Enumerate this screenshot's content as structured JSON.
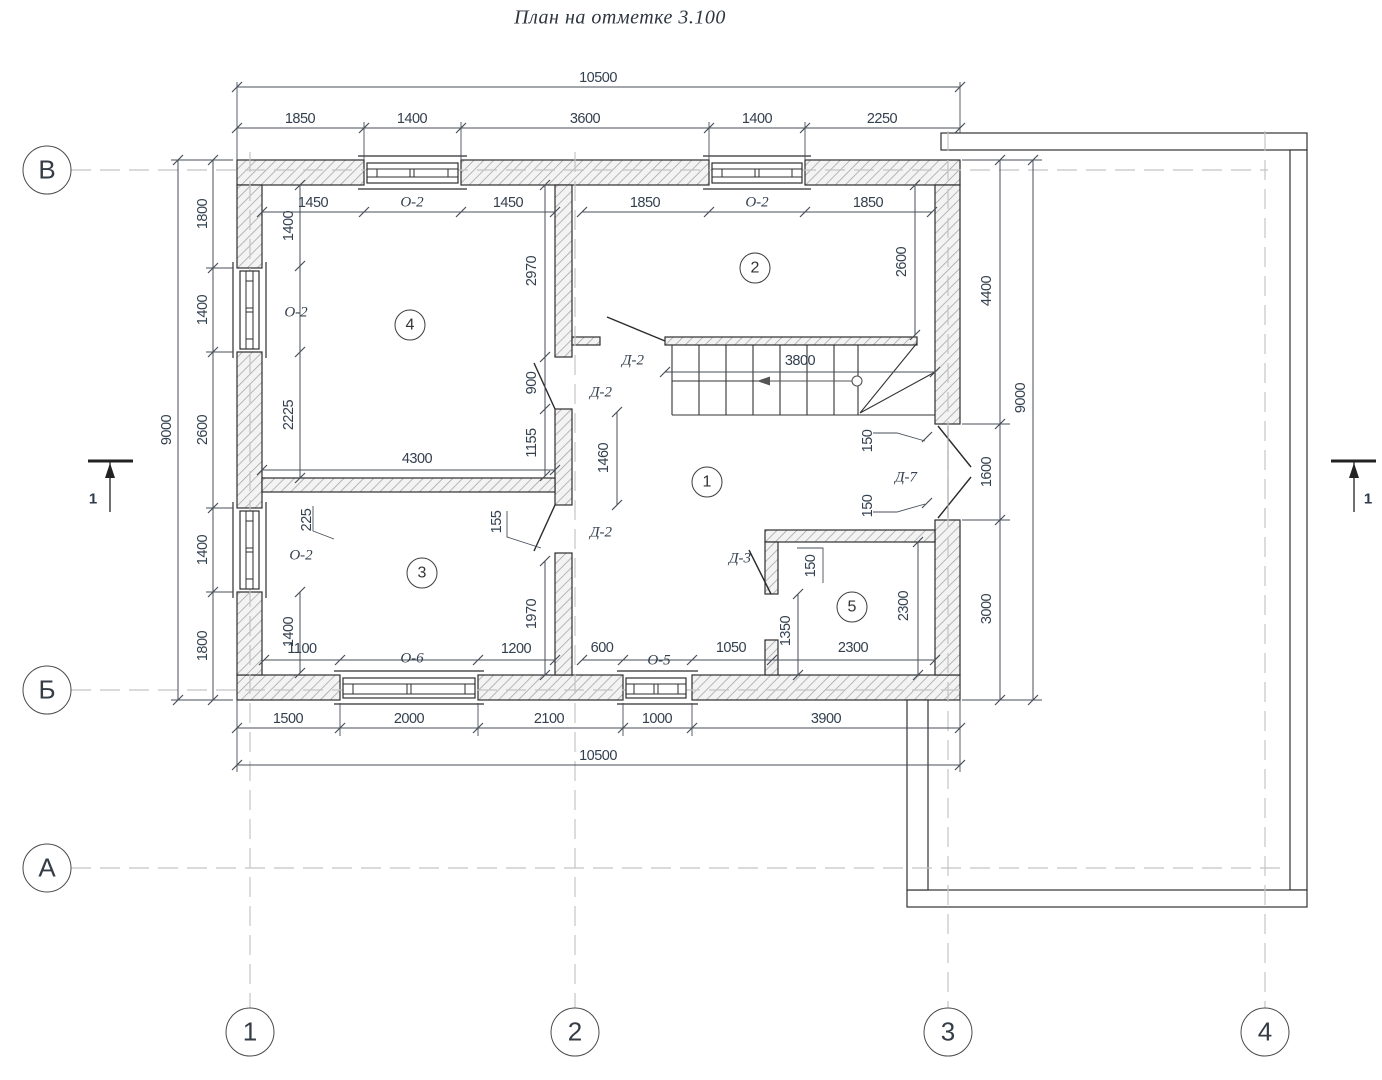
{
  "title": "План на отметке 3.100",
  "grid_axes": {
    "rows": [
      {
        "label": "В",
        "cx": 47,
        "cy": 170
      },
      {
        "label": "Б",
        "cx": 47,
        "cy": 690
      },
      {
        "label": "А",
        "cx": 47,
        "cy": 868
      }
    ],
    "cols": [
      {
        "label": "1",
        "cx": 250,
        "cy": 1032
      },
      {
        "label": "2",
        "cx": 575,
        "cy": 1032
      },
      {
        "label": "3",
        "cx": 948,
        "cy": 1032
      },
      {
        "label": "4",
        "cx": 1265,
        "cy": 1032
      }
    ]
  },
  "rooms": [
    {
      "number": "1",
      "cx": 707,
      "cy": 482
    },
    {
      "number": "2",
      "cx": 755,
      "cy": 268
    },
    {
      "number": "3",
      "cx": 422,
      "cy": 573
    },
    {
      "number": "4",
      "cx": 410,
      "cy": 325
    },
    {
      "number": "5",
      "cx": 852,
      "cy": 607
    }
  ],
  "section_marks": [
    {
      "label": "1",
      "x": 93,
      "y": 499
    },
    {
      "label": "1",
      "x": 1368,
      "y": 499
    }
  ],
  "opening_labels": [
    {
      "text": "О-2",
      "x": 412,
      "y": 203
    },
    {
      "text": "О-2",
      "x": 757,
      "y": 203
    },
    {
      "text": "О-2",
      "x": 296,
      "y": 313
    },
    {
      "text": "О-2",
      "x": 301,
      "y": 556
    },
    {
      "text": "О-6",
      "x": 412,
      "y": 659
    },
    {
      "text": "О-5",
      "x": 659,
      "y": 661
    },
    {
      "text": "Д-2",
      "x": 633,
      "y": 361
    },
    {
      "text": "Д-2",
      "x": 601,
      "y": 393
    },
    {
      "text": "Д-2",
      "x": 601,
      "y": 533
    },
    {
      "text": "Д-3",
      "x": 740,
      "y": 559
    },
    {
      "text": "Д-7",
      "x": 906,
      "y": 478
    }
  ],
  "dimensions": [
    {
      "text": "10500",
      "x": 598,
      "y": 78,
      "rot": 0
    },
    {
      "text": "1850",
      "x": 300,
      "y": 119,
      "rot": 0
    },
    {
      "text": "1400",
      "x": 412,
      "y": 119,
      "rot": 0
    },
    {
      "text": "3600",
      "x": 585,
      "y": 119,
      "rot": 0
    },
    {
      "text": "1400",
      "x": 757,
      "y": 119,
      "rot": 0
    },
    {
      "text": "2250",
      "x": 882,
      "y": 119,
      "rot": 0
    },
    {
      "text": "1450",
      "x": 313,
      "y": 203,
      "rot": 0
    },
    {
      "text": "1450",
      "x": 508,
      "y": 203,
      "rot": 0
    },
    {
      "text": "1850",
      "x": 645,
      "y": 203,
      "rot": 0
    },
    {
      "text": "1850",
      "x": 868,
      "y": 203,
      "rot": 0
    },
    {
      "text": "9000",
      "x": 167,
      "y": 430,
      "rot": 1
    },
    {
      "text": "1800",
      "x": 203,
      "y": 214,
      "rot": 1
    },
    {
      "text": "1400",
      "x": 203,
      "y": 310,
      "rot": 1
    },
    {
      "text": "2600",
      "x": 203,
      "y": 430,
      "rot": 1
    },
    {
      "text": "1400",
      "x": 203,
      "y": 550,
      "rot": 1
    },
    {
      "text": "1800",
      "x": 203,
      "y": 646,
      "rot": 1
    },
    {
      "text": "1400",
      "x": 289,
      "y": 226,
      "rot": 1
    },
    {
      "text": "2225",
      "x": 289,
      "y": 415,
      "rot": 1
    },
    {
      "text": "225",
      "x": 307,
      "y": 520,
      "rot": 1
    },
    {
      "text": "1400",
      "x": 289,
      "y": 632,
      "rot": 1
    },
    {
      "text": "1100",
      "x": 302,
      "y": 649,
      "rot": 0
    },
    {
      "text": "2970",
      "x": 532,
      "y": 271,
      "rot": 1
    },
    {
      "text": "900",
      "x": 532,
      "y": 383,
      "rot": 1
    },
    {
      "text": "1155",
      "x": 532,
      "y": 443,
      "rot": 1
    },
    {
      "text": "4300",
      "x": 417,
      "y": 459,
      "rot": 0
    },
    {
      "text": "1970",
      "x": 532,
      "y": 614,
      "rot": 1
    },
    {
      "text": "155",
      "x": 497,
      "y": 522,
      "rot": 1
    },
    {
      "text": "1200",
      "x": 516,
      "y": 649,
      "rot": 0
    },
    {
      "text": "1460",
      "x": 604,
      "y": 458,
      "rot": 1
    },
    {
      "text": "3800",
      "x": 800,
      "y": 361,
      "rot": 0
    },
    {
      "text": "2600",
      "x": 902,
      "y": 262,
      "rot": 1
    },
    {
      "text": "600",
      "x": 602,
      "y": 648,
      "rot": 0
    },
    {
      "text": "1050",
      "x": 731,
      "y": 648,
      "rot": 0
    },
    {
      "text": "2300",
      "x": 853,
      "y": 648,
      "rot": 0
    },
    {
      "text": "1350",
      "x": 786,
      "y": 631,
      "rot": 1
    },
    {
      "text": "150",
      "x": 811,
      "y": 566,
      "rot": 1
    },
    {
      "text": "2300",
      "x": 904,
      "y": 606,
      "rot": 1
    },
    {
      "text": "150",
      "x": 868,
      "y": 441,
      "rot": 1
    },
    {
      "text": "150",
      "x": 868,
      "y": 506,
      "rot": 1
    },
    {
      "text": "4400",
      "x": 987,
      "y": 291,
      "rot": 1
    },
    {
      "text": "1600",
      "x": 987,
      "y": 472,
      "rot": 1
    },
    {
      "text": "3000",
      "x": 987,
      "y": 609,
      "rot": 1
    },
    {
      "text": "9000",
      "x": 1021,
      "y": 398,
      "rot": 1
    },
    {
      "text": "1500",
      "x": 288,
      "y": 719,
      "rot": 0
    },
    {
      "text": "2000",
      "x": 409,
      "y": 719,
      "rot": 0
    },
    {
      "text": "2100",
      "x": 549,
      "y": 719,
      "rot": 0
    },
    {
      "text": "1000",
      "x": 657,
      "y": 719,
      "rot": 0
    },
    {
      "text": "3900",
      "x": 826,
      "y": 719,
      "rot": 0
    },
    {
      "text": "10500",
      "x": 598,
      "y": 756,
      "rot": 0
    }
  ]
}
